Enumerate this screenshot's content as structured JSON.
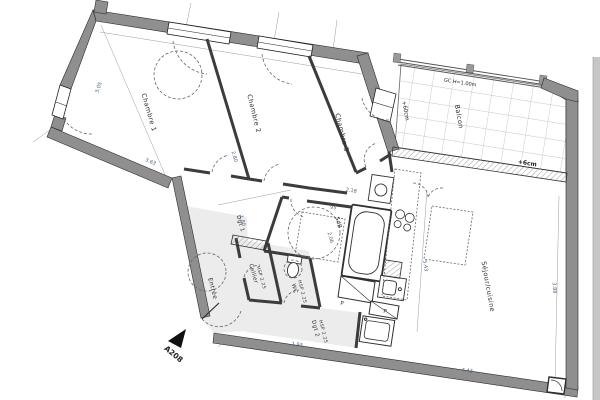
{
  "plan": {
    "rooms": {
      "chambre1": {
        "label": "Chambre 1"
      },
      "chambre2": {
        "label": "Chambre 2"
      },
      "chambre3": {
        "label": "Chambre 3"
      },
      "balcon": {
        "label": "Balcon"
      },
      "sejour": {
        "label": "Séjour/cuisine"
      },
      "entree": {
        "label": "Entrée"
      },
      "cellier": {
        "label": "Cellier",
        "hsp": "HSP 2.25"
      },
      "wc": {
        "label": "WC",
        "hsp": "HSP 2.25"
      },
      "sdb": {
        "label": "SdB"
      },
      "dgt1": {
        "label": "Dgt 1"
      },
      "dgt2": {
        "label": "Dgt 2",
        "hsp": "HSP 2.25"
      },
      "placard1": {
        "label": "P"
      },
      "placard2": {
        "label": "P"
      }
    },
    "annotations": {
      "apartment": "A208",
      "railing": "GC H=1.00m",
      "balcony_level": "+60cm",
      "terrace_level": "+6cm"
    },
    "dims": {
      "chambre1_depth": "3.05",
      "chambre1_width": "3.63",
      "chambre2_width": "2.80",
      "dgt1_width": "1.80",
      "sdb_width": "2.18",
      "sdb_small": "95",
      "sdb_depth": "2.06",
      "sejour_depth": "5.43",
      "sejour_right": "3.88",
      "sejour_width": "4.43",
      "dgt2_width": "1.93"
    },
    "colors": {
      "wall": "#8f8f8f",
      "partition": "#3c3c3c",
      "floor_tint": "#ececec",
      "dim_text": "#4a617c",
      "label_text": "#2e2e2e",
      "tile_line": "#b3b3b3",
      "paper": "#ffffff"
    }
  }
}
